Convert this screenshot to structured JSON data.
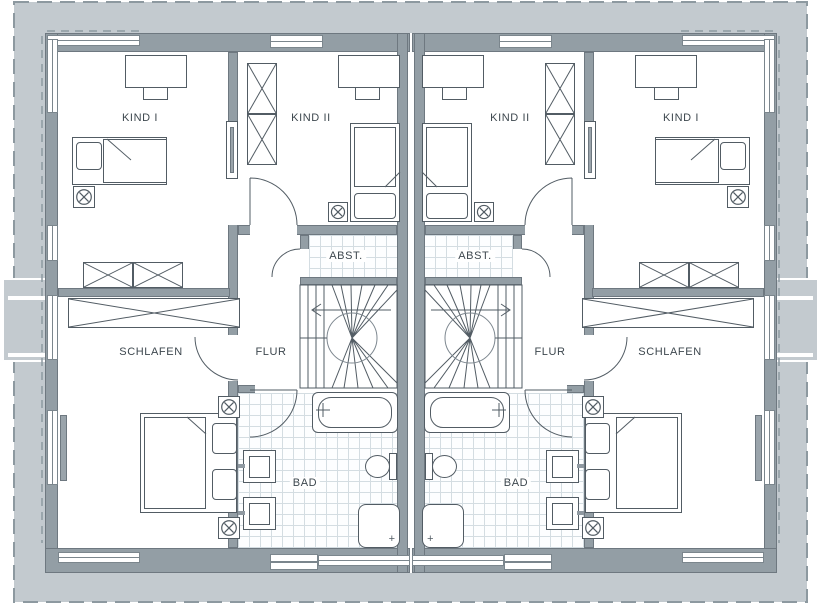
{
  "plan": {
    "drawing_type": "duplex-floor-plan",
    "colors": {
      "site_background": "#c3cacf",
      "wall_fill": "#939ea5",
      "wall_outline": "#6e7880",
      "furniture_line": "#525c64",
      "tile_line": "#d4dde2",
      "label_text": "#3d474e",
      "dashed_line": "#8d99a0"
    },
    "rooms": {
      "left_unit": {
        "kind1": "KIND I",
        "kind2": "KIND II",
        "schlafen": "SCHLAFEN",
        "flur": "FLUR",
        "abst": "ABST.",
        "bad": "BAD"
      },
      "right_unit": {
        "kind1": "KIND I",
        "kind2": "KIND II",
        "schlafen": "SCHLAFEN",
        "flur": "FLUR",
        "abst": "ABST.",
        "bad": "BAD"
      }
    },
    "icons": {
      "stool": "circle-x-stool-icon",
      "wardrobe": "crossed-box-wardrobe-icon",
      "stair_arrow": "direction-arrow-icon",
      "tap": "plus-tap-icon",
      "shower_drain": "plus-drain-icon"
    }
  }
}
